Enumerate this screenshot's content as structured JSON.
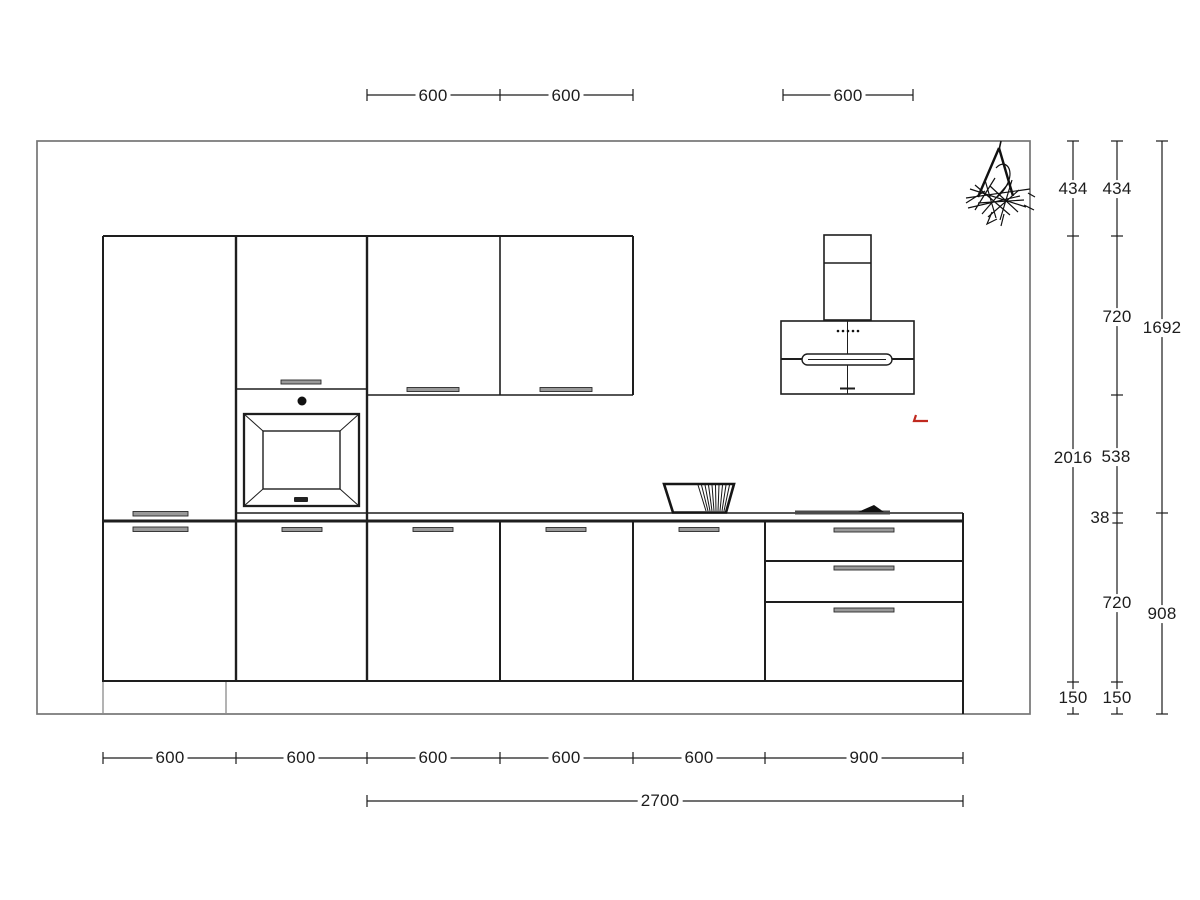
{
  "drawing_type": "kitchen-elevation",
  "dims": {
    "top": [
      "600",
      "600",
      "600"
    ],
    "bottom": [
      "600",
      "600",
      "600",
      "600",
      "600",
      "900"
    ],
    "total_run": "2700",
    "right_inner": [
      "434",
      "2016",
      "150"
    ],
    "right_middle": [
      "434",
      "720",
      "538",
      "38",
      "720",
      "150"
    ],
    "right_outer": [
      "1692",
      "908"
    ]
  },
  "colors": {
    "linework": "#1e1e1e",
    "room_outline": "#757575",
    "accent_red": "#c0291f"
  }
}
